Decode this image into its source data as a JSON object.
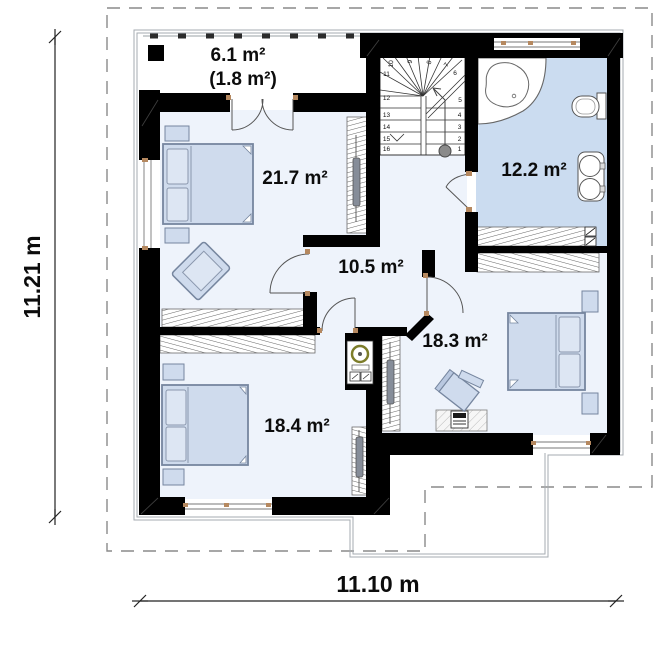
{
  "dimensions": {
    "vertical": "11.21 m",
    "horizontal": "11.10 m"
  },
  "rooms": [
    {
      "id": "balcony",
      "area": "6.1 m²",
      "area_secondary": "(1.8 m²)"
    },
    {
      "id": "bedroom-1",
      "area": "21.7 m²"
    },
    {
      "id": "bathroom",
      "area": "12.2 m²"
    },
    {
      "id": "hallway",
      "area": "10.5 m²"
    },
    {
      "id": "bedroom-2",
      "area": "18.3 m²"
    },
    {
      "id": "bedroom-3",
      "area": "18.4 m²"
    }
  ],
  "staircase": {
    "steps": [
      "1",
      "2",
      "3",
      "4",
      "5",
      "6",
      "7",
      "8",
      "9",
      "10",
      "11",
      "12",
      "13",
      "14",
      "15",
      "16"
    ]
  },
  "colors": {
    "wall": "#000000",
    "room_fill": "#eef3fb",
    "bathroom_fill": "#cbdcf0",
    "furniture_fill": "#cfdbed",
    "wood_marker": "#b5885f",
    "roof_dash": "#8a8a8a"
  }
}
